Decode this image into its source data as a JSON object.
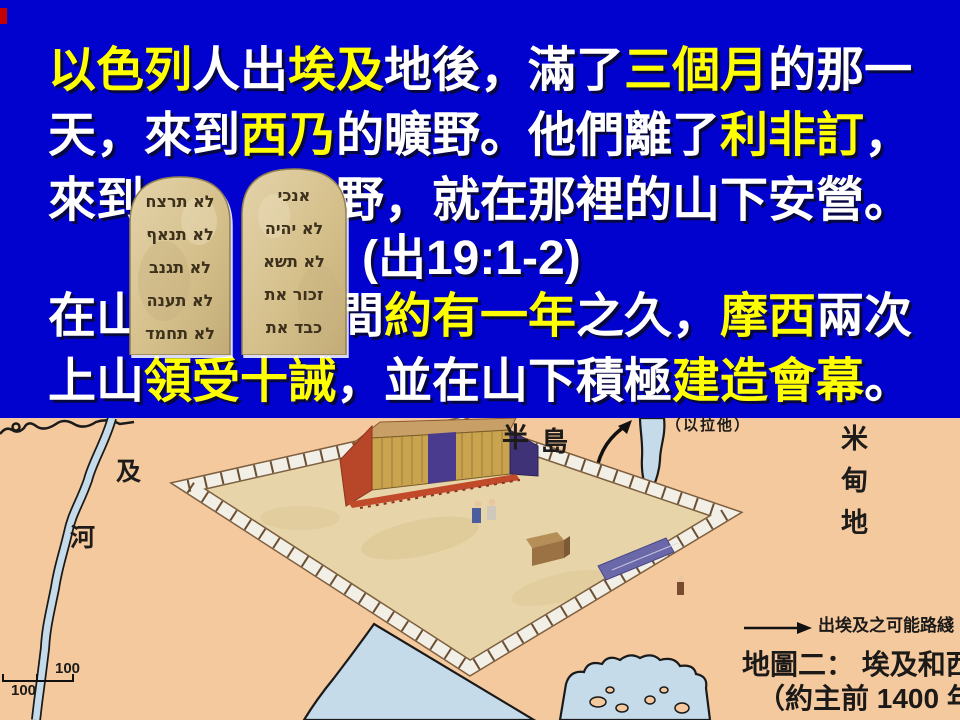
{
  "slide_type": "presentation-slide",
  "banner": {
    "line1": [
      {
        "t": "以色列",
        "c": "yellow"
      },
      {
        "t": "人出",
        "c": "white"
      },
      {
        "t": "埃及",
        "c": "yellow"
      },
      {
        "t": "地後，滿了",
        "c": "white"
      },
      {
        "t": "三個月",
        "c": "yellow"
      },
      {
        "t": "的那一",
        "c": "white"
      }
    ],
    "line2": [
      {
        "t": "天，來到",
        "c": "white"
      },
      {
        "t": "西乃",
        "c": "yellow"
      },
      {
        "t": "的曠野。他們離了",
        "c": "white"
      },
      {
        "t": "利非訂",
        "c": "yellow"
      },
      {
        "t": "，",
        "c": "white"
      }
    ],
    "line3a": [
      {
        "t": "來到",
        "c": "white"
      }
    ],
    "line3b": [
      {
        "t": "野，就在那裡的山下安營。",
        "c": "white"
      }
    ],
    "line4": [
      {
        "t": "(出19:1-2)",
        "c": "white"
      }
    ],
    "line5a": [
      {
        "t": "在山",
        "c": "white"
      }
    ],
    "line5b": [
      {
        "t": "間",
        "c": "white"
      },
      {
        "t": "約有一年",
        "c": "yellow"
      },
      {
        "t": "之久，",
        "c": "white"
      },
      {
        "t": "摩西",
        "c": "yellow"
      },
      {
        "t": "兩次",
        "c": "white"
      }
    ],
    "line6": [
      {
        "t": "上山",
        "c": "white"
      },
      {
        "t": "領受十誡",
        "c": "yellow"
      },
      {
        "t": "，並在山下積極",
        "c": "white"
      },
      {
        "t": "建造會幕",
        "c": "yellow"
      },
      {
        "t": "。",
        "c": "white"
      }
    ]
  },
  "tablets": {
    "left_lines": [
      "לא תרצח",
      "לא תנאף",
      "לא תגנב",
      "לא תענה",
      "לא תחמד"
    ],
    "right_lines": [
      "אנכי",
      "לא יהיה",
      "לא תשא",
      "זכור את",
      "כבד את"
    ]
  },
  "map": {
    "labels": {
      "egypt_char": "及",
      "river_char": "河",
      "peninsula_char1": "半",
      "peninsula_char2": "島",
      "eilat": "（以拉他）",
      "midian": "米甸地",
      "scale_right": "100",
      "scale_left": "100",
      "legend_route": "出埃及之可能路綫",
      "caption_title": "地圖二： 埃及和西奈",
      "caption_date": "（約主前 1400 年）"
    }
  },
  "colors": {
    "banner_bg": "#0202CF",
    "text_white": "#FFFFFF",
    "text_yellow": "#FFFF00",
    "map_bg": "#F5C99E",
    "water": "#C5DBEA",
    "coastline": "#1a1a1a",
    "tablet_stone": "#D9C48F",
    "courtyard_sand": "#E7D5A9",
    "fence_white": "#F2EFE6",
    "tent_gold": "#C9A34E",
    "tent_purple": "#4A3B8F",
    "tent_red": "#B8472A"
  }
}
